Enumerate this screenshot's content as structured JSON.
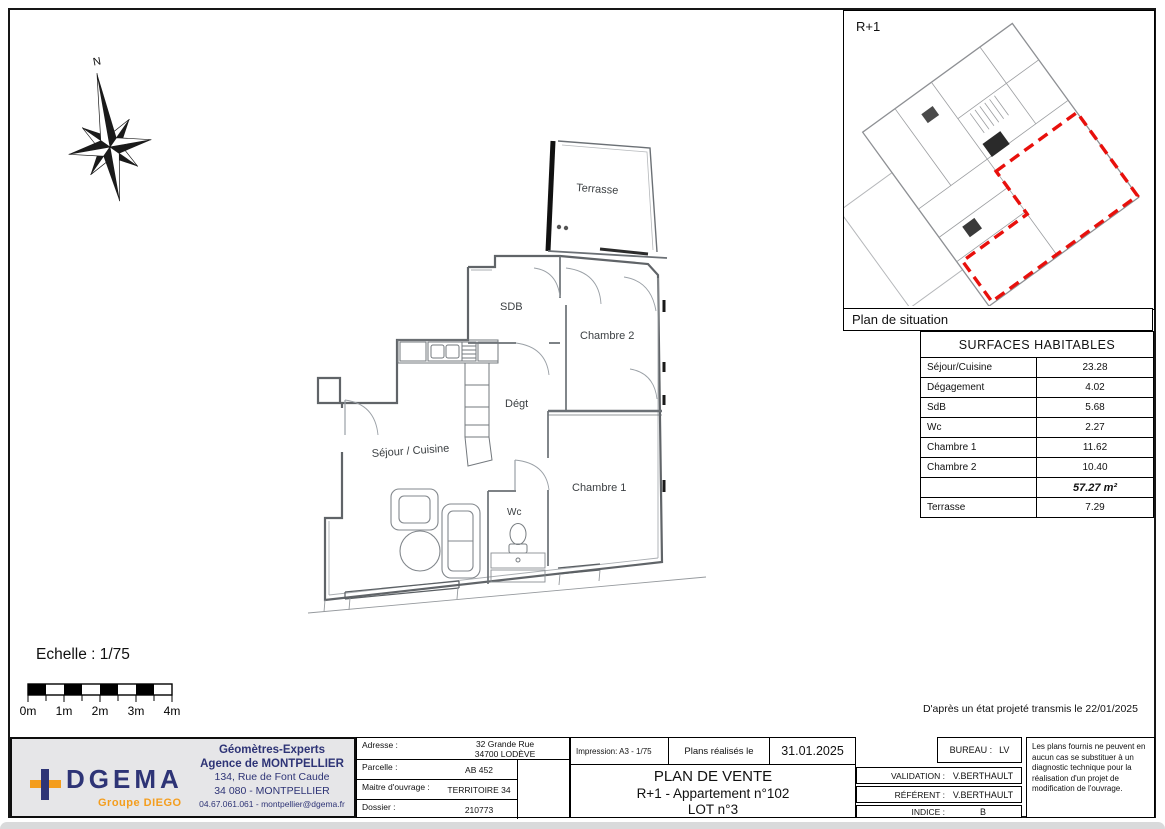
{
  "page": {
    "note_projected": "D'après un état projeté transmis le 22/01/2025"
  },
  "compass": {
    "north_label": "N"
  },
  "floor_plan": {
    "rooms": [
      {
        "label": "Terrasse"
      },
      {
        "label": "SDB"
      },
      {
        "label": "Chambre 2"
      },
      {
        "label": "Dégt"
      },
      {
        "label": "Séjour / Cuisine"
      },
      {
        "label": "Wc"
      },
      {
        "label": "Chambre 1"
      }
    ]
  },
  "situation": {
    "floor_label": "R+1",
    "caption": "Plan de situation",
    "highlight_color": "#e8100c"
  },
  "surfaces_table": {
    "title": "SURFACES HABITABLES",
    "rows": [
      {
        "label": "Séjour/Cuisine",
        "value": "23.28"
      },
      {
        "label": "Dégagement",
        "value": "4.02"
      },
      {
        "label": "SdB",
        "value": "5.68"
      },
      {
        "label": "Wc",
        "value": "2.27"
      },
      {
        "label": "Chambre 1",
        "value": "11.62"
      },
      {
        "label": "Chambre 2",
        "value": "10.40"
      },
      {
        "label": "",
        "value": "57.27 m²"
      },
      {
        "label": "Terrasse",
        "value": "7.29"
      }
    ]
  },
  "scale_bar": {
    "label": "Echelle : 1/75",
    "ticks": [
      "0m",
      "1m",
      "2m",
      "3m",
      "4m"
    ]
  },
  "title_block": {
    "company": {
      "brand": "DGEMA",
      "group": "Groupe DIEGO",
      "line1": "Géomètres-Experts",
      "line2": "Agence de MONTPELLIER",
      "line3": "134, Rue de Font Caude",
      "line4": "34 080 - MONTPELLIER",
      "line5": "04.67.061.061 - montpellier@dgema.fr",
      "navy": "#2e3476",
      "orange": "#f49d1d"
    },
    "fields": [
      {
        "label": "Adresse :",
        "value": "32 Grande Rue",
        "value2": "34700 LODÈVE"
      },
      {
        "label": "Parcelle :",
        "value": "AB 452"
      },
      {
        "label": "Maitre d'ouvrage :",
        "value": "TERRITOIRE 34"
      },
      {
        "label": "Dossier :",
        "value": "210773"
      }
    ],
    "print_info": {
      "impression": "Impression:  A3 - 1/75",
      "made_label": "Plans réalisés le",
      "made_date": "31.01.2025"
    },
    "titles": {
      "line1": "PLAN DE VENTE",
      "line2": "R+1 - Appartement n°102",
      "line3": "LOT n°3"
    },
    "admin": {
      "bureau_label": "BUREAU :",
      "bureau_value": "LV",
      "rows": [
        {
          "label": "VALIDATION :",
          "value": "V.BERTHAULT"
        },
        {
          "label": "RÉFÉRENT :",
          "value": "V.BERTHAULT"
        },
        {
          "label": "INDICE :",
          "value": "B"
        }
      ]
    },
    "disclaimer": "Les plans fournis ne peuvent en aucun cas se substituer à un diagnostic technique pour la réalisation d'un projet de modification de l'ouvrage."
  }
}
